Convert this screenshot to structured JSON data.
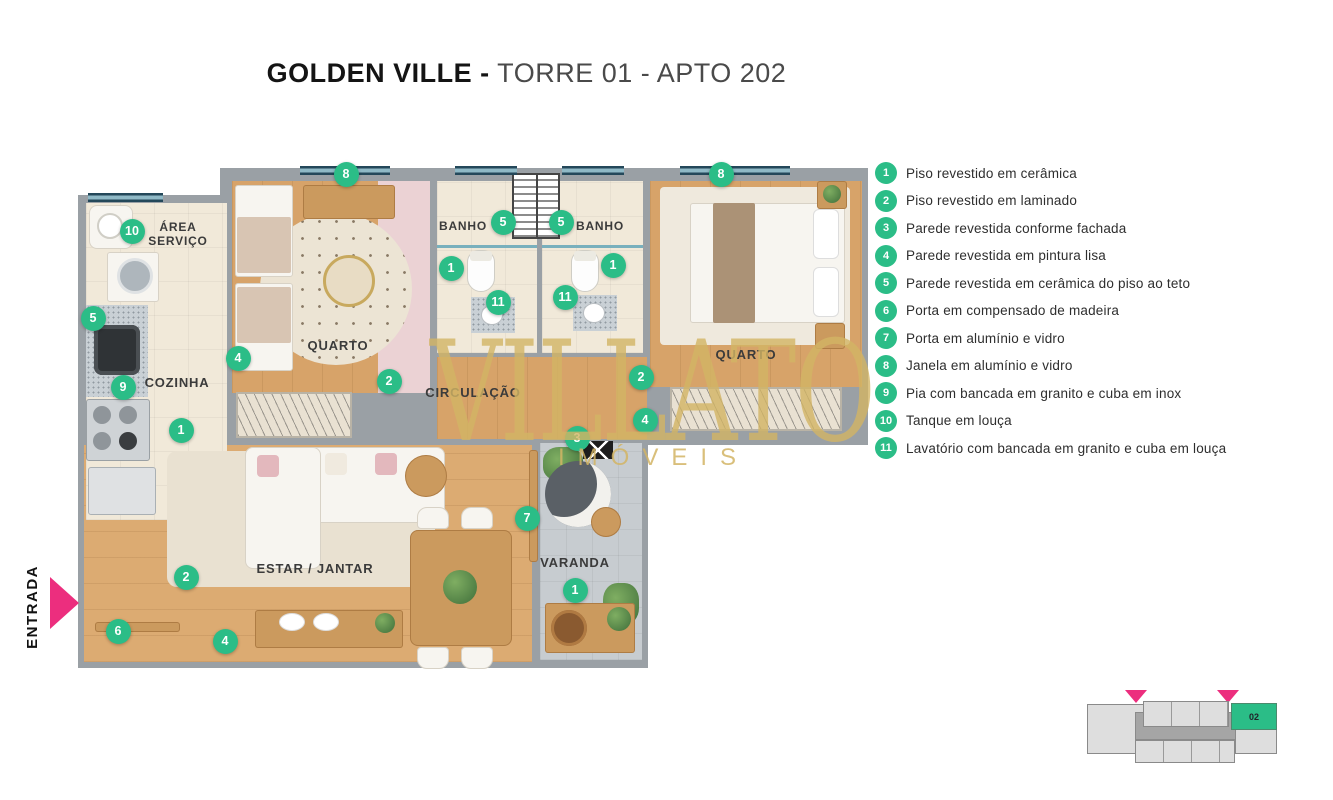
{
  "title": {
    "brand": "GOLDEN VILLE -",
    "rest": " TORRE 01 - APTO 202"
  },
  "watermark": {
    "name": "VILLATO",
    "subtitle": "IMÓVEIS"
  },
  "entrance": {
    "label": "ENTRADA"
  },
  "colors": {
    "green": "#2bbd87",
    "pink": "#ec2e7e",
    "gold": "#d3b565"
  },
  "rooms": {
    "area_servico": "ÁREA\nSERVIÇO",
    "cozinha": "COZINHA",
    "quarto1": "QUARTO",
    "banho1": "BANHO",
    "banho2": "BANHO",
    "quarto2": "QUARTO",
    "circulacao": "CIRCULAÇÃO",
    "estar_jantar": "ESTAR / JANTAR",
    "varanda": "VARANDA"
  },
  "legend": {
    "items": [
      {
        "num": "1",
        "label": "Piso revestido em cerâmica"
      },
      {
        "num": "2",
        "label": "Piso revestido em laminado"
      },
      {
        "num": "3",
        "label": "Parede revestida conforme fachada"
      },
      {
        "num": "4",
        "label": "Parede revestida em pintura lisa"
      },
      {
        "num": "5",
        "label": "Parede revestida em cerâmica do piso ao teto"
      },
      {
        "num": "6",
        "label": "Porta em compensado de madeira"
      },
      {
        "num": "7",
        "label": "Porta em alumínio e vidro"
      },
      {
        "num": "8",
        "label": "Janela em alumínio e vidro"
      },
      {
        "num": "9",
        "label": "Pia com bancada em granito e cuba em inox"
      },
      {
        "num": "10",
        "label": "Tanque em louça"
      },
      {
        "num": "11",
        "label": "Lavatório com bancada em granito e cuba em louça"
      }
    ]
  },
  "plan": {
    "markers": [
      {
        "n": "10",
        "x": 57,
        "y": 76
      },
      {
        "n": "5",
        "x": 18,
        "y": 163
      },
      {
        "n": "9",
        "x": 48,
        "y": 232
      },
      {
        "n": "1",
        "x": 106,
        "y": 275
      },
      {
        "n": "4",
        "x": 163,
        "y": 203
      },
      {
        "n": "8",
        "x": 271,
        "y": 19
      },
      {
        "n": "2",
        "x": 314,
        "y": 226
      },
      {
        "n": "1",
        "x": 376,
        "y": 113
      },
      {
        "n": "5",
        "x": 428,
        "y": 67
      },
      {
        "n": "11",
        "x": 423,
        "y": 147
      },
      {
        "n": "5",
        "x": 486,
        "y": 67
      },
      {
        "n": "11",
        "x": 490,
        "y": 142
      },
      {
        "n": "1",
        "x": 538,
        "y": 110
      },
      {
        "n": "8",
        "x": 646,
        "y": 19
      },
      {
        "n": "2",
        "x": 566,
        "y": 222
      },
      {
        "n": "4",
        "x": 570,
        "y": 265
      },
      {
        "n": "3",
        "x": 502,
        "y": 283
      },
      {
        "n": "7",
        "x": 452,
        "y": 363
      },
      {
        "n": "1",
        "x": 500,
        "y": 435
      },
      {
        "n": "2",
        "x": 111,
        "y": 422
      },
      {
        "n": "6",
        "x": 43,
        "y": 476
      },
      {
        "n": "4",
        "x": 150,
        "y": 486
      }
    ]
  },
  "minimap": {
    "unit_label": "02"
  }
}
